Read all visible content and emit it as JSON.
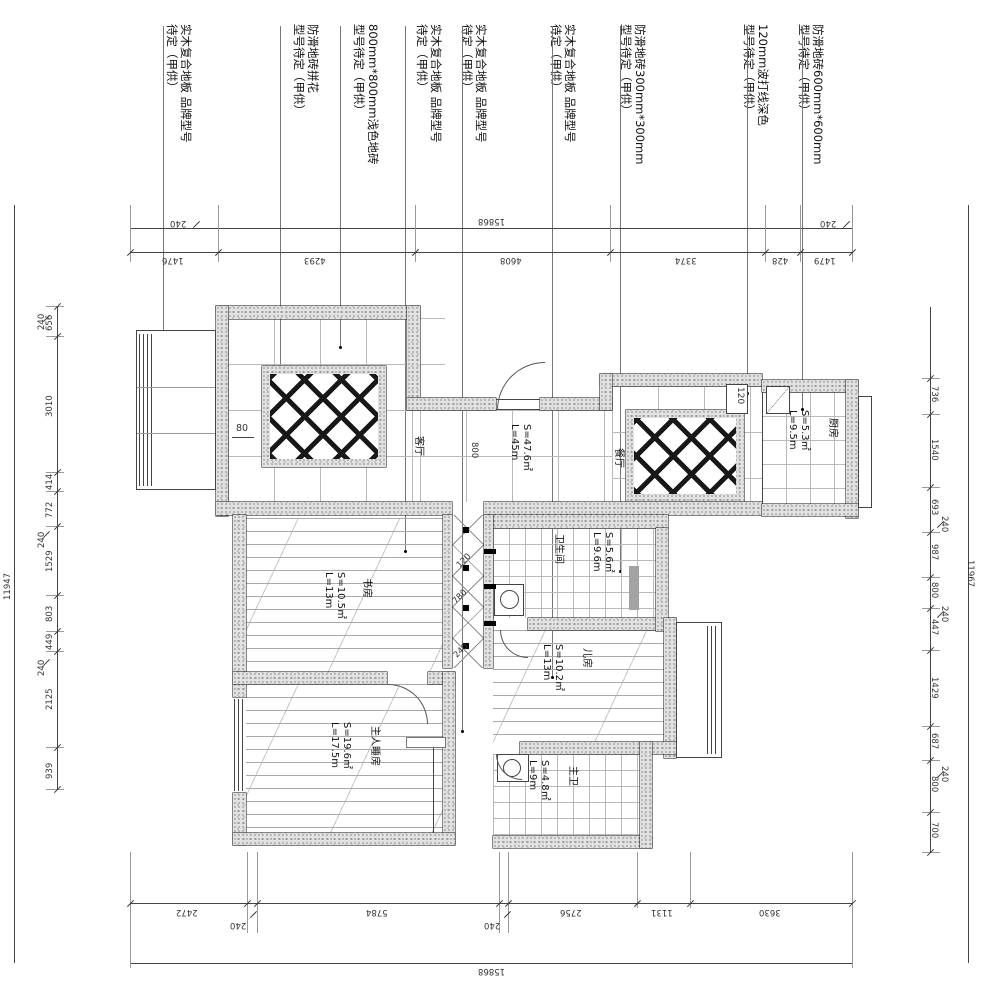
{
  "annotations": [
    {
      "line1": "实木复合地板 品牌型号",
      "line2": "待定（甲供）"
    },
    {
      "line1": "防滑地砖拼花",
      "line2": "型号待定（甲供）"
    },
    {
      "line1": "800mm*800mm浅色地砖",
      "line2": "型号待定（甲供）"
    },
    {
      "line1": "实木复合地板 品牌型号",
      "line2": "待定（甲供）"
    },
    {
      "line1": "实木复合地板 品牌型号",
      "line2": "待定（甲供）"
    },
    {
      "line1": "实木复合地板 品牌型号",
      "line2": "待定（甲供）"
    },
    {
      "line1": "防滑地砖300mm*300mm",
      "line2": "型号待定（甲供）"
    },
    {
      "line1": "120mm波打线深色",
      "line2": "型号待定（甲供）"
    },
    {
      "line1": "防滑地砖600mm*600mm",
      "line2": "型号待定（甲供）"
    }
  ],
  "dims": {
    "top": {
      "overall": "15868",
      "segments": [
        "1476",
        "4293",
        "4608",
        "3374",
        "428",
        "1479"
      ],
      "leader": "240"
    },
    "bottom": {
      "overall": "15868",
      "segments": [
        "2472",
        "5784",
        "2756",
        "1131",
        "3630"
      ],
      "leader": "240"
    },
    "left": {
      "overall": "11947",
      "segments": [
        "656",
        "3010",
        "414",
        "772",
        "1529",
        "803",
        "449",
        "2125",
        "939"
      ],
      "leader": "240"
    },
    "right": {
      "overall": "11967",
      "segments": [
        "736",
        "1540",
        "693",
        "987",
        "800",
        "447",
        "1429",
        "687",
        "800",
        "700"
      ],
      "leader": "240"
    }
  },
  "rooms": {
    "living": {
      "name": "客厅",
      "area": "S=47.6㎡",
      "length": "L=45m"
    },
    "dining": {
      "name": "餐厅"
    },
    "kitchen": {
      "name": "厨房",
      "area": "S=5.3㎡",
      "length": "L=9.5m"
    },
    "bath": {
      "name": "卫生间",
      "area": "S=5.6㎡",
      "length": "L=9.6m"
    },
    "study": {
      "name": "书房",
      "area": "S=10.5㎡",
      "length": "L=13m"
    },
    "kids": {
      "name": "儿房",
      "area": "S=10.2㎡",
      "length": "L=13m"
    },
    "master": {
      "name": "主人睡房",
      "area": "S=19.6㎡",
      "length": "L=17.5m"
    },
    "mbath": {
      "name": "主卫",
      "area": "S=4.8㎡",
      "length": "L=9m"
    }
  },
  "plan_labels": {
    "d80": "80",
    "d800": "800",
    "d120": "120",
    "c120": "120",
    "c780": "780",
    "c240": "240"
  }
}
